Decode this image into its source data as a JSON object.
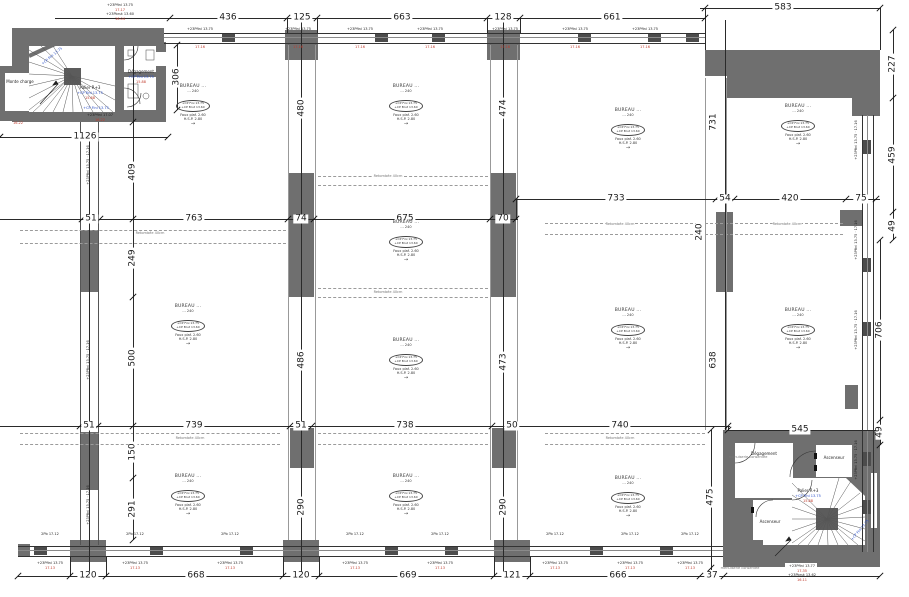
{
  "drawing": {
    "type": "floor-plan",
    "level_name": "Palier R+3"
  },
  "colors": {
    "wall": "#6f6f6f",
    "mullion": "#4c4c4c",
    "line": "#2a2a2a",
    "red": "#c03a2b",
    "blue": "#2b50c8",
    "dash": "#9b9b9b"
  },
  "dimensions": {
    "top": [
      "436",
      "125",
      "663",
      "128",
      "661",
      "583"
    ],
    "upper_mid_left": [
      "51",
      "763",
      "74",
      "675",
      "70"
    ],
    "upper_mid_right": [
      "733",
      "54",
      "420",
      "75"
    ],
    "lower_mid": [
      "51",
      "739",
      "51",
      "738",
      "50",
      "740",
      "545"
    ],
    "bottom": [
      "120",
      "668",
      "120",
      "669",
      "121",
      "666",
      "37"
    ],
    "left_chain": [
      "1126",
      "409",
      "249",
      "500",
      "150",
      "291",
      "306"
    ],
    "right_chain": [
      "227",
      "459",
      "49",
      "706",
      "49",
      "240",
      "475"
    ],
    "band_verticals": [
      "480",
      "474",
      "731",
      "486",
      "473",
      "638",
      "290",
      "290"
    ]
  },
  "rooms": {
    "bureau": {
      "title": "BUREAU ...",
      "line2": "... 240",
      "oval1": "+CP Fini 13.75",
      "oval2": "+CP Brut 13.60",
      "line5": "Faux plaf. 2.60",
      "line6": "H.S.P. 2.80",
      "arrow": "→"
    },
    "monte_charge": "Monte charge",
    "degagement": "Dégagement",
    "ascenseur": "Ascenseur",
    "palier": "Palier R+3"
  },
  "levels": {
    "tl": [
      {
        "t": "+23Pfini 13.75",
        "c": "k"
      },
      {
        "t": "17.17",
        "c": "r"
      },
      {
        "t": "+23Pbrut 13.60",
        "c": "k"
      },
      {
        "t": "16.04",
        "c": "r"
      }
    ],
    "tl2": [
      {
        "t": "+23Pfini 17.07",
        "c": "k"
      },
      {
        "t": "16.22",
        "c": "r"
      }
    ],
    "br": [
      {
        "t": "+23Pfini 13.77",
        "c": "k"
      },
      {
        "t": "17.35",
        "c": "r"
      },
      {
        "t": "+23Pbrut 13.62",
        "c": "k"
      },
      {
        "t": "16.11",
        "c": "r"
      }
    ],
    "stair_blue": "+CP Fini 13.75",
    "stair_red": "15.88",
    "menuiserie": "menuiserie conservée"
  },
  "window_note": {
    "top_black": "+23Pfini 13.75",
    "top_red": "17.16",
    "bottom_small": "2Pb 17.12",
    "bottom_black": "+23Pfini 13.75",
    "bottom_red": "17.13",
    "side": "+23Pfini 13.75 · 17.16"
  },
  "beam_label": "Retombée 40cm"
}
